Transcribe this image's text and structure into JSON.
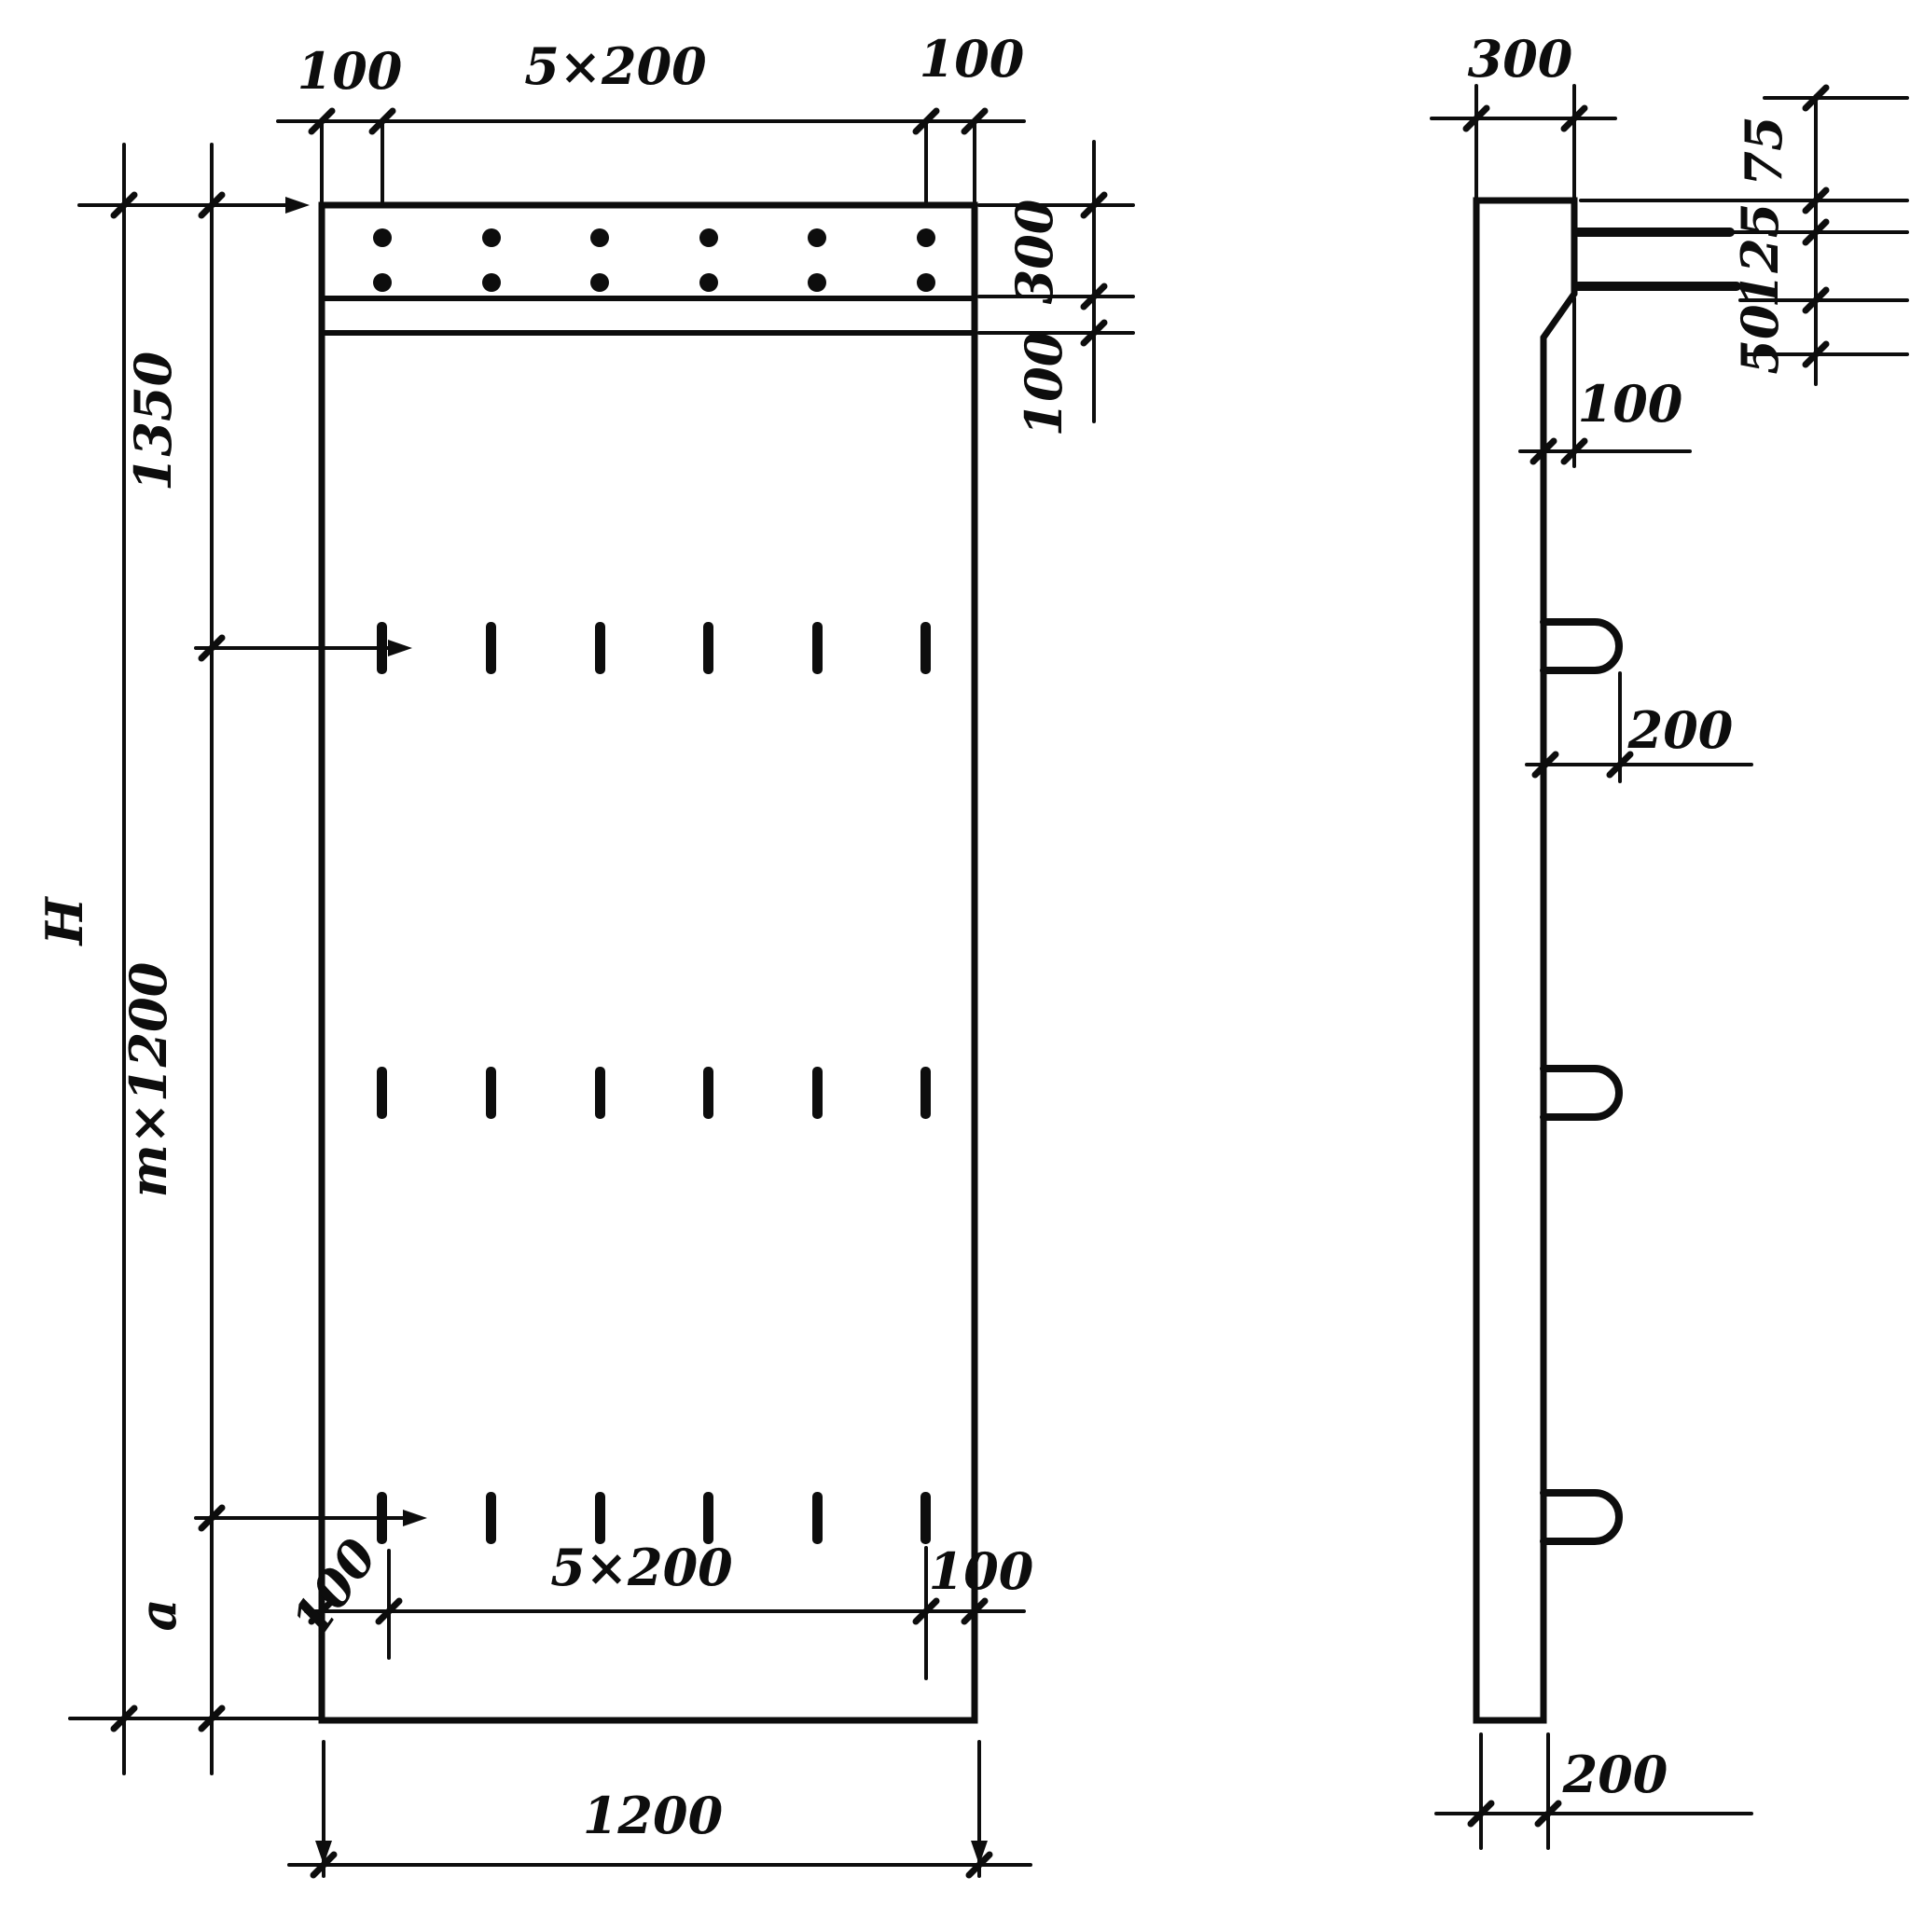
{
  "drawing_title": "Panel dimension drawing, front and side views",
  "front": {
    "top": {
      "left": "100",
      "mid": "5×200",
      "right": "100"
    },
    "right": {
      "band": "300",
      "step": "100"
    },
    "left": {
      "overall": "H",
      "top": "1350",
      "mid": "m×1200",
      "bottom": "a"
    },
    "lower": {
      "left": "100",
      "mid": "5×200",
      "right": "100"
    },
    "width": "1200"
  },
  "side": {
    "top_width": "300",
    "right": {
      "first": "75",
      "second": "125",
      "third": "50"
    },
    "step": "100",
    "hook": "200",
    "bottom": "200"
  }
}
